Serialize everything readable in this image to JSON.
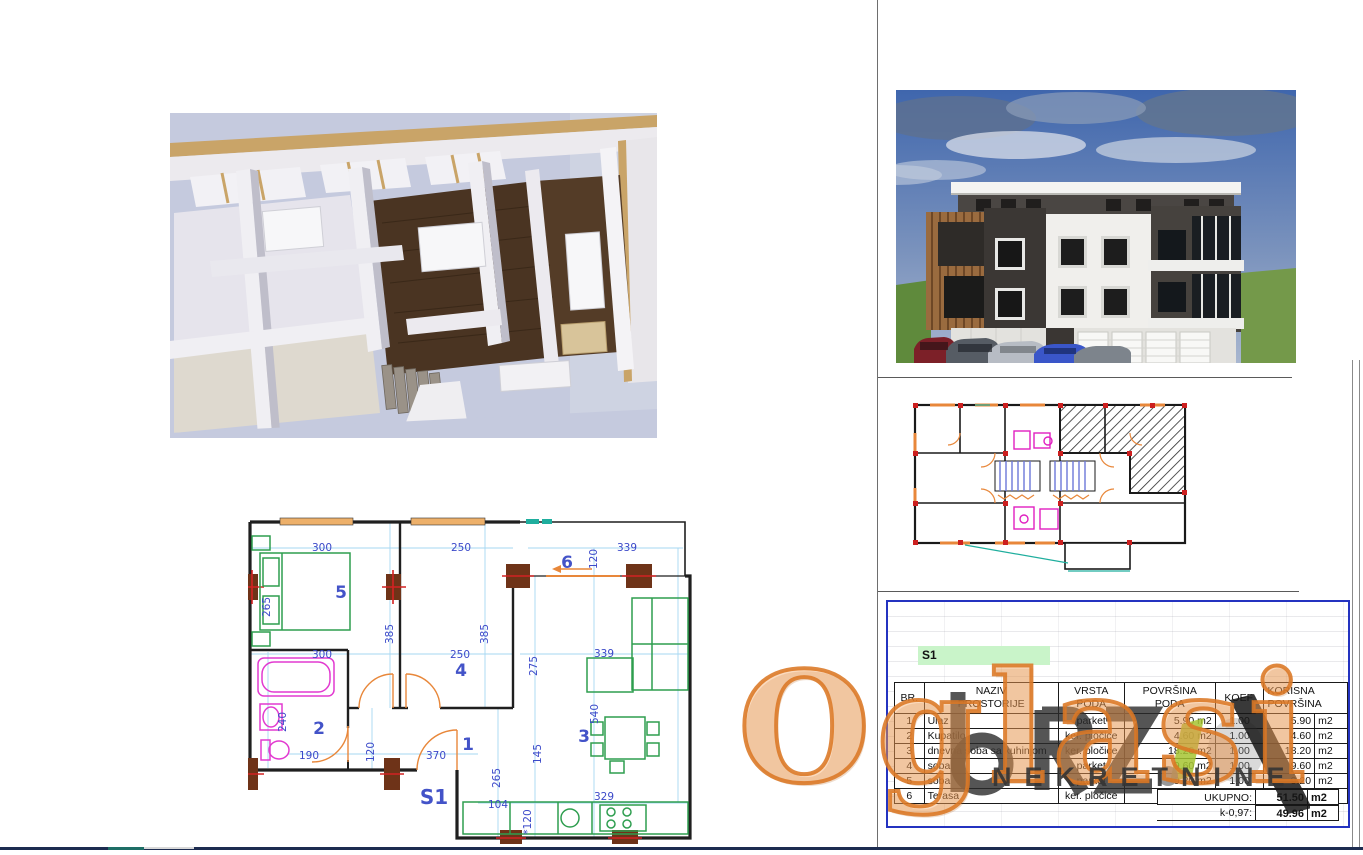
{
  "page": {
    "background": "#ffffff"
  },
  "colors": {
    "plan_dim_blue": "#3b49c9",
    "plan_room_blue": "#4353c8",
    "furniture_green": "#2e9e4f",
    "bath_magenta": "#e23ad0",
    "door_orange": "#e8873a",
    "column_brown": "#6e3318",
    "column_red": "#d42222",
    "teal": "#1fae9e",
    "table_border_blue": "#2433c0",
    "watermark_orange": "#db7824",
    "watermark_green": "#a6c431",
    "watermark_dark": "#343434"
  },
  "floorplan": {
    "unit": "S1",
    "rooms": [
      "5",
      "4",
      "6",
      "2",
      "1",
      "3"
    ],
    "dims": [
      "300",
      "250",
      "120",
      "339",
      "265",
      "385",
      "385",
      "300",
      "250",
      "275",
      "339",
      "240",
      "190",
      "120",
      "370",
      "265",
      "145",
      "540",
      "104",
      "329",
      "*120"
    ]
  },
  "table": {
    "unit": "S1",
    "headers": {
      "br": "BR.",
      "naziv_l1": "NAZIV",
      "naziv_l2": "PROSTORIJE",
      "vrsta_l1": "VRSTA",
      "vrsta_l2": "PODA",
      "povrsina_l1": "POVRŠINA",
      "povrsina_l2": "PODA",
      "koef": "KOEF.",
      "korisna_l1": "KORISNA",
      "korisna_l2": "POVRŠINA"
    },
    "rows": [
      {
        "br": "1",
        "naziv": "Ulaz",
        "vrsta": "parket",
        "povrsina": "5.90 m2",
        "koef": "1.00",
        "korisna": "5.90",
        "unit": "m2"
      },
      {
        "br": "2",
        "naziv": "Kupatilo",
        "vrsta": "ker. pločice",
        "povrsina": "4.60 m2",
        "koef": "1.00",
        "korisna": "4.60",
        "unit": "m2"
      },
      {
        "br": "3",
        "naziv": "dnevna soba sa kuhinjom",
        "vrsta": "ker. pločice",
        "povrsina": "18.20 m2",
        "koef": "1.00",
        "korisna": "18.20",
        "unit": "m2"
      },
      {
        "br": "4",
        "naziv": "soba",
        "vrsta": "parket",
        "povrsina": "9.60 m2",
        "koef": "1.00",
        "korisna": "9.60",
        "unit": "m2"
      },
      {
        "br": "5",
        "naziv": "soba",
        "vrsta": "parket",
        "povrsina": "9.20 m2",
        "koef": "1.00",
        "korisna": "9.20",
        "unit": "m2"
      },
      {
        "br": "6",
        "naziv": "Terasa",
        "vrsta": "ker. pločice",
        "povrsina": "8.00 m2",
        "koef": "0.50",
        "korisna": "4.00",
        "unit": "m2"
      }
    ],
    "total_label": "UKUPNO:",
    "total_value": "51.50",
    "total_unit": "m2",
    "k_label": "k-0,97:",
    "k_value": "49.96",
    "k_unit": "m2"
  },
  "watermark": {
    "brand": "Oglasi",
    "category": "NEKRETNINE"
  }
}
